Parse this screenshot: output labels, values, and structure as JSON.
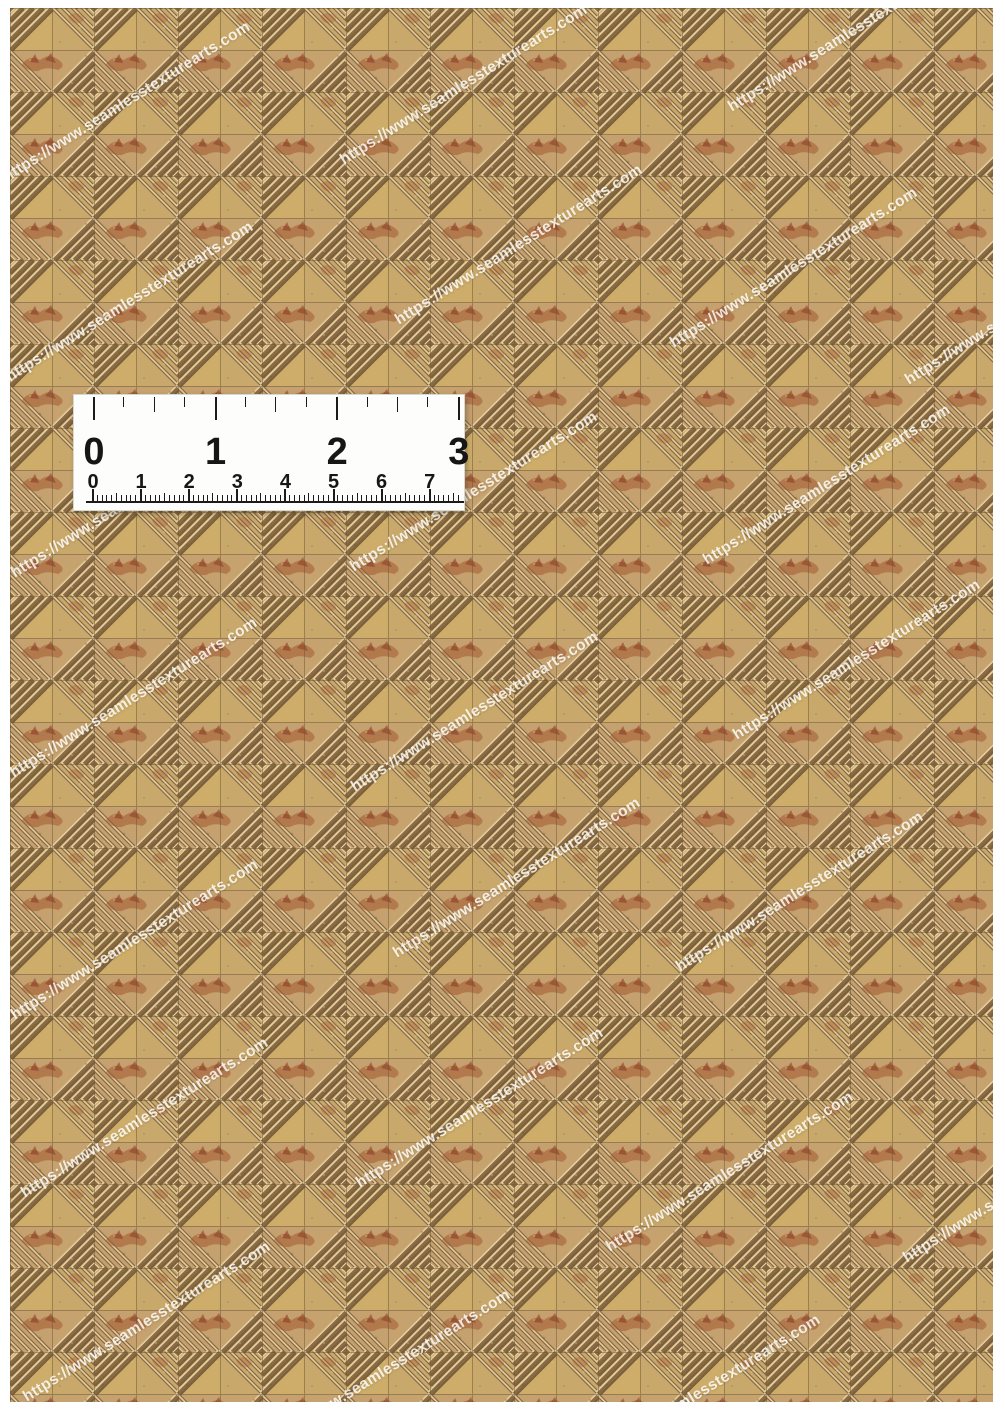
{
  "page": {
    "width": 1005,
    "height": 1421,
    "background": "#ffffff"
  },
  "texture": {
    "description": "seamless wood parquet mosaic tile texture swatch",
    "left": 10,
    "top": 8,
    "width": 983,
    "height": 1394,
    "tile_size": 42,
    "cell_size": 84,
    "palette": {
      "base": "#c7a770",
      "tan": "#c2a172",
      "yellow": "#d4b461",
      "pink": "#c0976b",
      "groove_dark": "#5f4729",
      "groove_mid": "#8a6a44",
      "highlight": "#ead7a6",
      "rust": "#a0512c",
      "rust_dark": "#86381f",
      "seam": "#6e5534",
      "speck_dark": "#6a4f2c",
      "speck_light": "#ecdcb0"
    }
  },
  "watermark": {
    "text": "https://www.seamlesstexturearts.com",
    "color": "#ffffff",
    "opacity": 0.82,
    "font_size": 15.5,
    "angle_deg": -32,
    "positions": [
      [
        10,
        187
      ],
      [
        347,
        170
      ],
      [
        735,
        117
      ],
      [
        13,
        387
      ],
      [
        402,
        330
      ],
      [
        677,
        353
      ],
      [
        912,
        390
      ],
      [
        18,
        583
      ],
      [
        357,
        577
      ],
      [
        710,
        570
      ],
      [
        17,
        783
      ],
      [
        358,
        797
      ],
      [
        740,
        745
      ],
      [
        18,
        1025
      ],
      [
        400,
        963
      ],
      [
        683,
        977
      ],
      [
        28,
        1203
      ],
      [
        363,
        1193
      ],
      [
        613,
        1257
      ],
      [
        910,
        1268
      ],
      [
        30,
        1407
      ],
      [
        270,
        1455
      ],
      [
        580,
        1480
      ]
    ]
  },
  "ruler": {
    "left": 73,
    "top": 394,
    "width": 392,
    "height": 117,
    "background": "#fdfdfc",
    "tick_color": "#1b1b1b",
    "digit_color": "#161616",
    "inch_scale": {
      "unit": "inches",
      "labels": [
        "0",
        "1",
        "2",
        "3"
      ],
      "origin_x": 19,
      "spacing": 121.6,
      "tick_len_major": 23,
      "tick_len_half": 15,
      "tick_len_quarter": 10,
      "label_font_size": 38,
      "label_top": 36
    },
    "cm_scale": {
      "unit": "cm",
      "labels": [
        "0",
        "1",
        "2",
        "3",
        "4",
        "5",
        "6",
        "7"
      ],
      "origin_x": 18,
      "spacing": 48.1,
      "baseline_y": 106,
      "ticks_end_x": 388,
      "tick_len_cm": 12,
      "tick_len_5mm": 8,
      "tick_len_mm": 6,
      "label_font_size": 20,
      "label_top": 76
    }
  }
}
